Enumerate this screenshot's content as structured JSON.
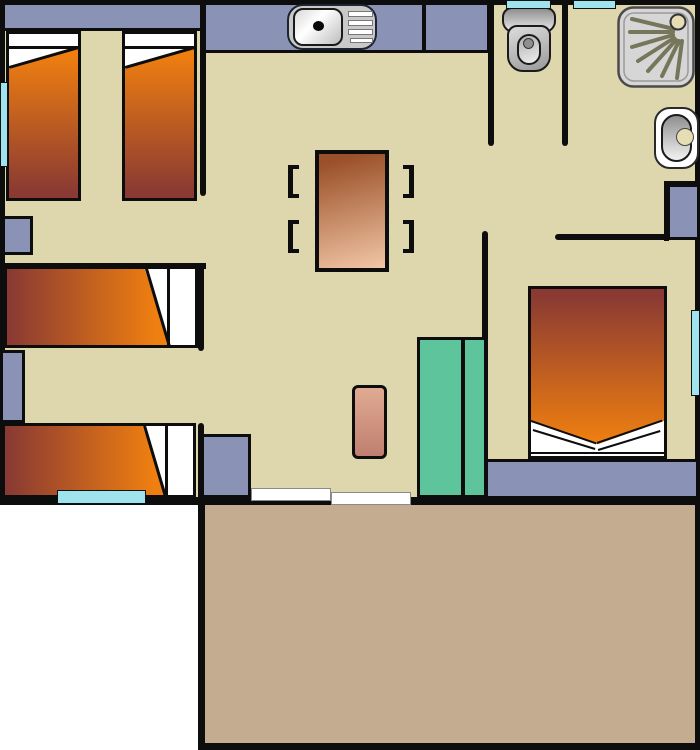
{
  "plan": {
    "type": "floor-plan",
    "rooms": [
      {
        "id": "bedroom-twin",
        "area": "top-left",
        "fixtures": [
          "wardrobe-strip",
          "single-bed-1",
          "single-bed-2",
          "nightstand-a",
          "window-left-wall"
        ]
      },
      {
        "id": "kitchen-living",
        "area": "center",
        "fixtures": [
          "kitchen-counter",
          "kitchen-sink",
          "dining-table",
          "chair-bracket-x4",
          "rug",
          "wardrobe-teal",
          "cabinet",
          "sliding-door"
        ]
      },
      {
        "id": "toilet-room",
        "area": "top-middle-right",
        "fixtures": [
          "toilet",
          "window-toilet-top"
        ]
      },
      {
        "id": "bathroom",
        "area": "top-right",
        "fixtures": [
          "shower-tray",
          "washbasin",
          "corner-cupboard",
          "window-shower-top"
        ]
      },
      {
        "id": "bedroom-single",
        "area": "left-middle",
        "fixtures": [
          "single-bed-3",
          "single-bed-4",
          "nightstand-b",
          "window-bottom-wall"
        ]
      },
      {
        "id": "bedroom-double",
        "area": "right",
        "fixtures": [
          "double-bed",
          "headboard-shelf",
          "window-right-wall"
        ]
      },
      {
        "id": "terrace",
        "area": "bottom",
        "fixtures": []
      }
    ]
  },
  "colors": {
    "outside": "#ffffff",
    "floor": "#ded6ac",
    "wall": "#0d0d0d",
    "furnitureBlue": "#8a93b6",
    "terrace": "#c3ac90",
    "window": "#9fe3ee",
    "teal": "#5ec49b",
    "bedOrange": "#ef7f10",
    "bedDark": "#8a3a33",
    "tableDark": "#9a5028",
    "tableLight": "#f2c6a6",
    "rugLight": "#e0ab92",
    "rugDark": "#bf7f70",
    "brass": "#e6ddb4",
    "spray": "#76765a",
    "showerTray": "#d6d6d6"
  }
}
